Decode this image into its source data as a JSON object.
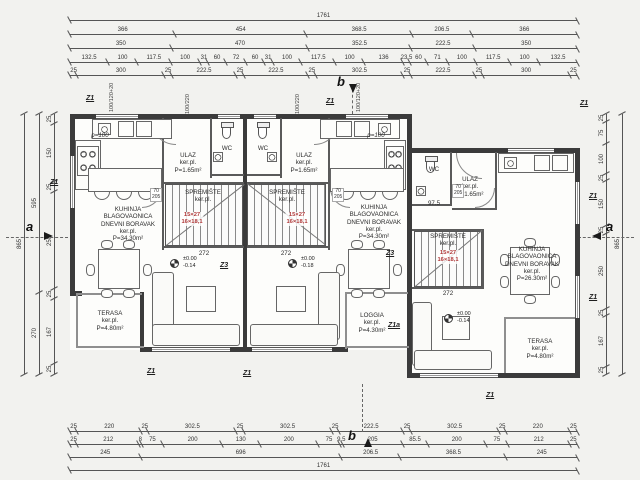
{
  "colors": {
    "wall": "#3b3b3b",
    "dim_line": "#555555",
    "red_note": "#b03a3a",
    "background": "#f2f2ef"
  },
  "sections": {
    "a": "a",
    "b": "b"
  },
  "tags": {
    "z1": "Z1",
    "z3": "Z3",
    "z1a": "Z1a"
  },
  "levels": {
    "left": "±0.00\n-0.14",
    "mid": "±0.00\n-0.18",
    "right": "±0.00\n-0.14"
  },
  "stairs_note": "15×27\n16×18,1",
  "rooms": {
    "living_left": "KUHINJA\nBLAGOVAONICA\nDNEVNI BORAVAK\nker.pl.\nP=34.30m²",
    "living_mid": "KUHINJA\nBLAGOVAONICA\nDNEVNI BORAVAK\nker.pl.\nP=34.30m²",
    "living_right": "KUHINJA\nBLAGOVAONICA\nDNEVNI BORAVAK\nker.pl.\nP=26.30m²",
    "ulaz": "ULAZ\nker.pl.\nP=1.65m²",
    "wc": "WC",
    "spremiste": "SPREMIŠTE\nker.pl.",
    "terasa": "TERASA\nker.pl.\nP=4.80m²",
    "loggia": "LOGGIA\nker.pl.\nP=4.30m²"
  },
  "annotations": {
    "d272": "272",
    "d97": "97.5",
    "p100": "p=100",
    "door": "70\n205",
    "win_a": "100/120+20",
    "win_b": "100/220"
  },
  "dims": {
    "top": [
      [
        "1761"
      ],
      [
        "366",
        "454",
        "368.5",
        "206.5",
        "366"
      ],
      [
        "350",
        "470",
        "352.5",
        "222.5",
        "350"
      ],
      [
        "132.5",
        "100",
        "117.5",
        "100",
        "31",
        "60",
        "72",
        "60",
        "31",
        "100",
        "117.5",
        "100",
        "136",
        "23.5",
        "60",
        "71",
        "100",
        "117.5",
        "100",
        "132.5"
      ],
      [
        "25",
        "300",
        "25",
        "222.5",
        "25",
        "222.5",
        "25",
        "302.5",
        "25",
        "222.5",
        "25",
        "300",
        "25"
      ]
    ],
    "bottom": [
      [
        "25",
        "220",
        "25",
        "302.5",
        "25",
        "302.5",
        "25",
        "222.5",
        "25",
        "302.5",
        "25",
        "220",
        "25"
      ],
      [
        "25",
        "212",
        "8",
        "75",
        "200",
        "130",
        "200",
        "75",
        "9.5",
        "205",
        "85.5",
        "200",
        "75",
        "212",
        "25"
      ],
      [
        "245",
        "696",
        "206.5",
        "368.5",
        "245"
      ],
      [
        "1761"
      ]
    ],
    "left": [
      [
        "865"
      ],
      [
        "595",
        "270"
      ],
      [
        "25",
        "150",
        "25",
        "250",
        "25",
        "167",
        "25"
      ]
    ],
    "right": [
      [
        "25",
        "75",
        "100",
        "25",
        "150",
        "25",
        "250",
        "25",
        "167",
        "25"
      ],
      [
        "865"
      ]
    ]
  }
}
